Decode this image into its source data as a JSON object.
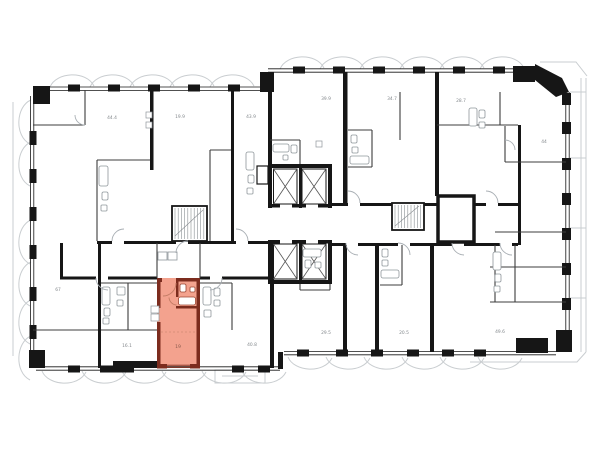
{
  "plan": {
    "type": "residential-floor-plan",
    "colors": {
      "background": "#ffffff",
      "walls": "#161616",
      "thin_walls": "#3c3c3c",
      "balcony_lines": "#c9cdd0",
      "fixture_lines": "#8f969b",
      "door_arcs": "#a9afb4",
      "label_text": "#84898d",
      "highlight_fill": "#f3a28e",
      "highlight_wall": "#7c2c1e",
      "highlight_accent": "#c27b64"
    },
    "highlighted_unit": {
      "area_label": "19",
      "status": "selected"
    },
    "room_labels": [
      {
        "text": "44.4"
      },
      {
        "text": "19.9"
      },
      {
        "text": "43.9"
      },
      {
        "text": "39.9"
      },
      {
        "text": "34.7"
      },
      {
        "text": "28.7"
      },
      {
        "text": "44"
      },
      {
        "text": "67"
      },
      {
        "text": "16.1"
      },
      {
        "text": "40.8"
      },
      {
        "text": "29.5"
      },
      {
        "text": "20.5"
      },
      {
        "text": "49.6"
      }
    ],
    "icons": [
      {
        "name": "elevator-icon",
        "glyph": "crossed-box",
        "count": 4
      },
      {
        "name": "stairs-icon",
        "glyph": "tread-hatch",
        "count": 2
      }
    ]
  }
}
